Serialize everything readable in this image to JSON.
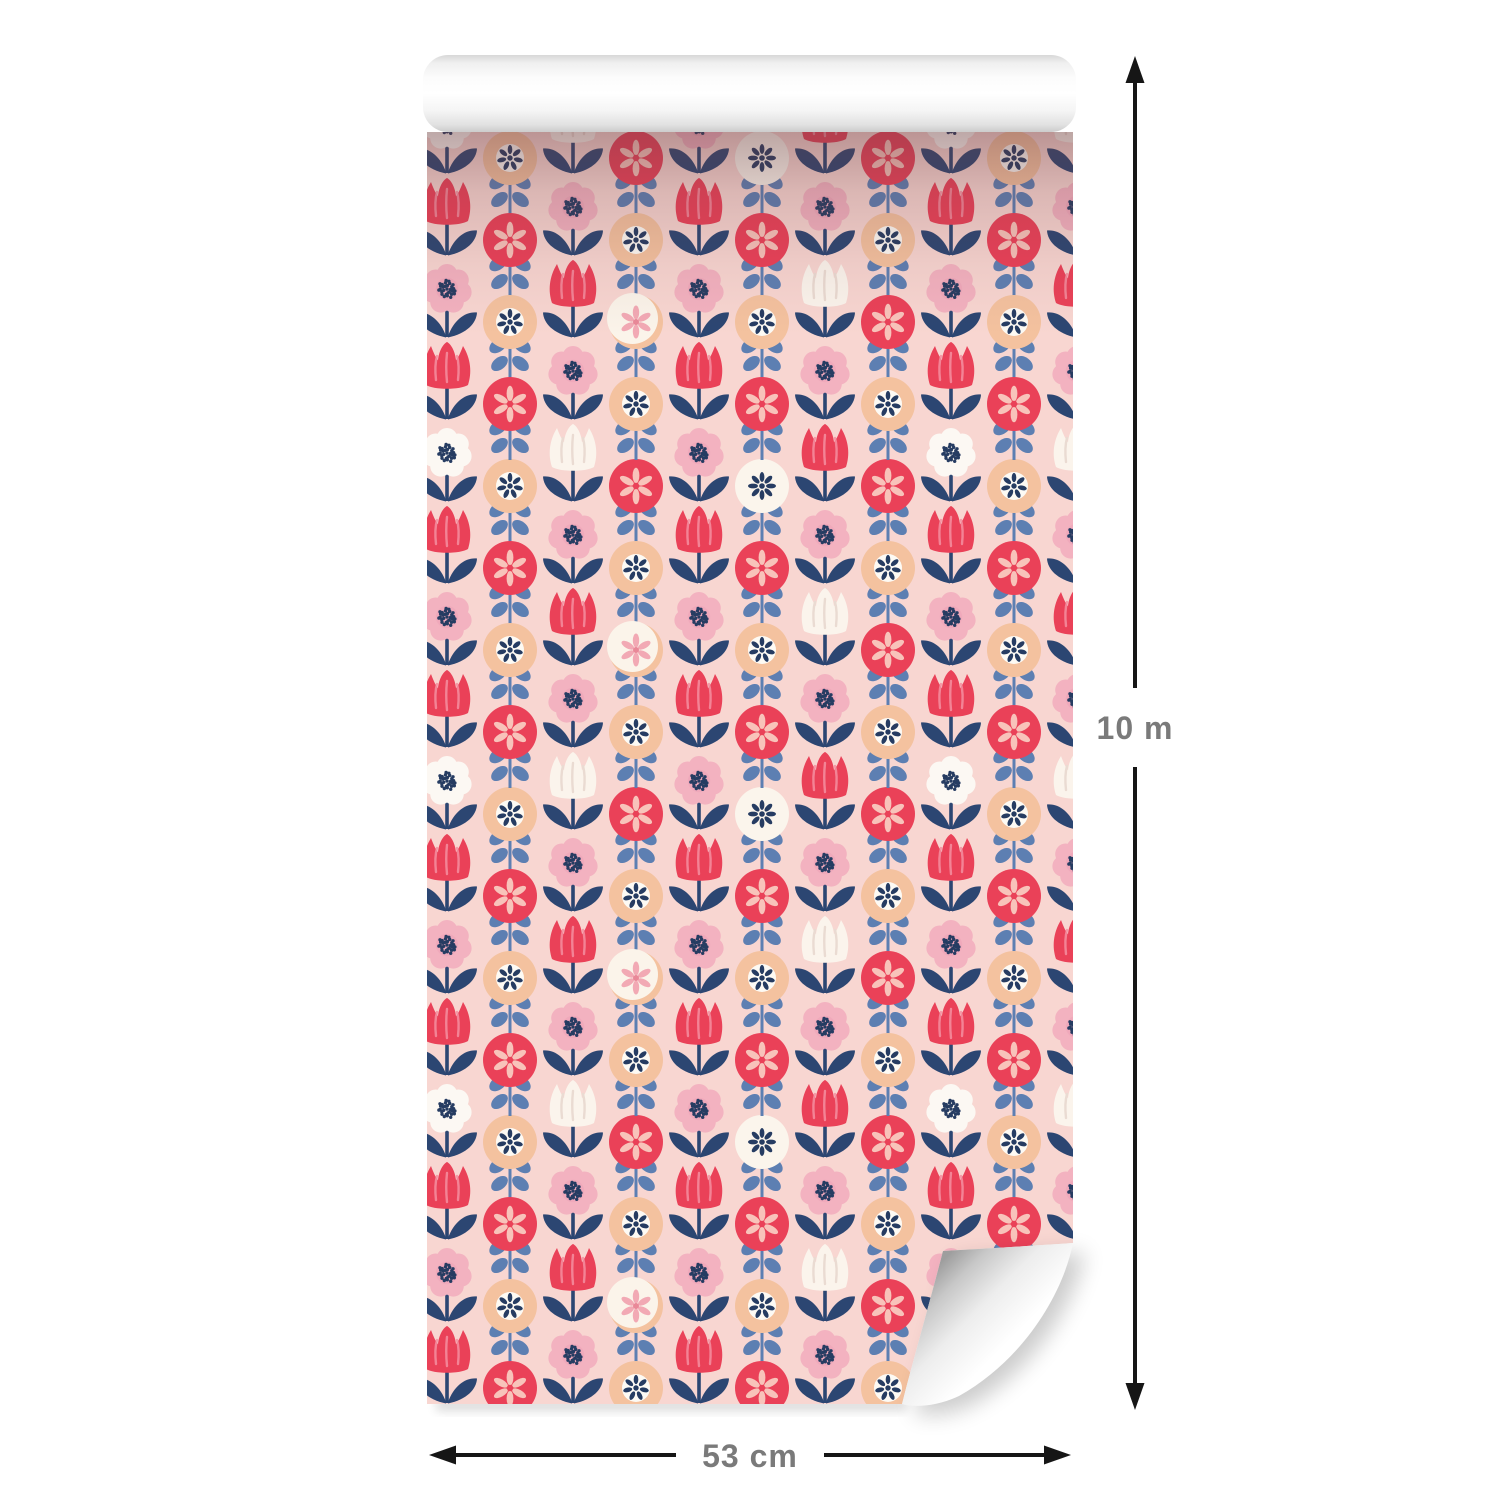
{
  "image": {
    "description": "Product render of a decorative wallpaper roll with retro folk floral pattern and size annotations",
    "labels": {
      "height": "10 m",
      "width": "53 cm"
    },
    "annotation": {
      "text_color": "#7a7a7a",
      "arrow_color": "#161616"
    },
    "pattern": {
      "background_color": "#f8d6d1",
      "red": "#ea4158",
      "petal_pink": "#f3b2c0",
      "leaf_navy": "#2c4672",
      "leaf_blue": "#5d7fb2",
      "peach": "#f4c29f",
      "cream": "#fbf4ec",
      "dot_navy": "#263c62",
      "motifs": [
        "red-tulip",
        "white-tulip",
        "pink-flower-dotted-center",
        "white-daisy-dotted-center",
        "peach-circle-flower",
        "red-circle-flower",
        "cream-circle-flower"
      ]
    },
    "roll": {
      "paper_color": "#ffffff"
    }
  }
}
